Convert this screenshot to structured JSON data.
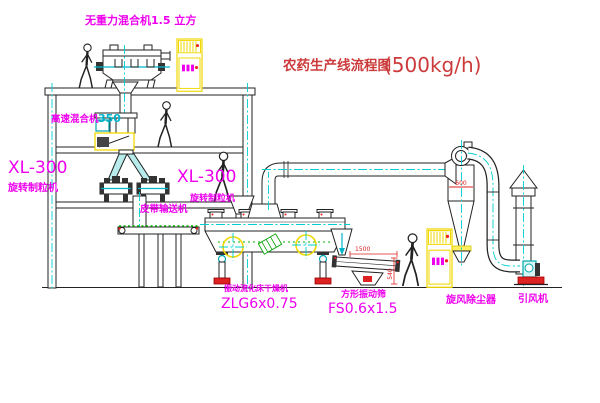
{
  "title": {
    "name": "农药生产线流程图",
    "capacity": "(500kg/h)"
  },
  "labels": {
    "gravity_mixer": "无重力混合机1.5 立方",
    "high_speed_mixer_name": "高速混合机",
    "high_speed_mixer_size": "350",
    "granulator_left_model": "XL-300",
    "granulator_left_name": "旋转制粒机",
    "granulator_mid_model": "XL-300",
    "granulator_mid_name": "旋转制粒机",
    "belt_conveyor": "皮带输送机",
    "dryer_name": "振动流化床干燥机",
    "dryer_model": "ZLG6x0.75",
    "sieve_name": "方形振动筛",
    "sieve_model": "FS0.6x1.5",
    "cyclone_name": "旋风除尘器",
    "fan_name": "引风机"
  },
  "dimensions": {
    "sieve_length": "1500",
    "sieve_height": "540",
    "cyclone_marking": "600"
  },
  "colors": {
    "label_magenta": "#ee00ee",
    "title_red": "#cc3b3b",
    "dimension_red": "#dd2222",
    "centerline_cyan": "#00cfcf",
    "highlight_yellow": "#f0d800",
    "conveyor_green": "#00b300",
    "line_black": "#222222",
    "background": "#ffffff"
  }
}
